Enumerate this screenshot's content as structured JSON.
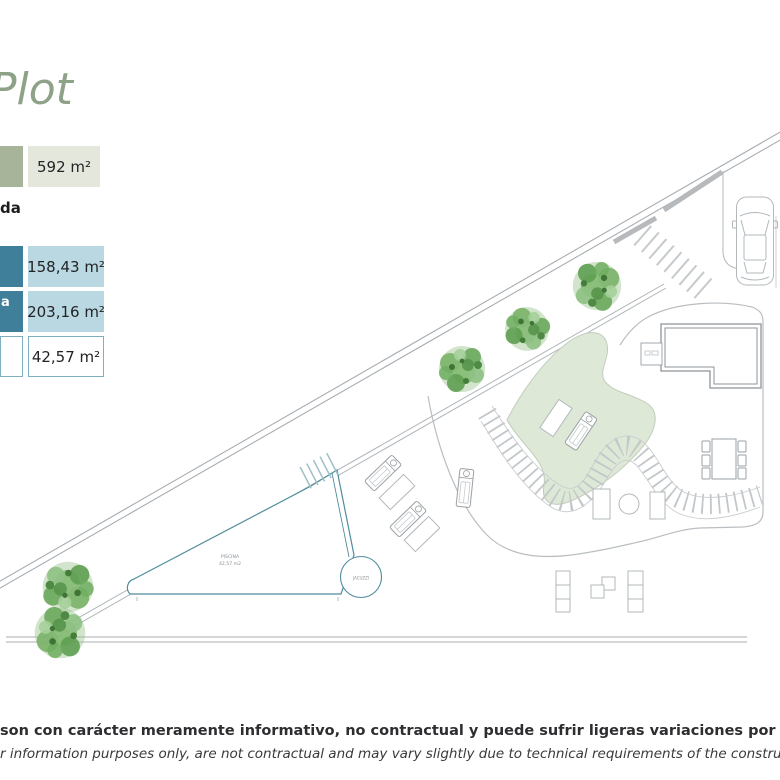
{
  "header": {
    "title": "Plot",
    "title_color": "#8da287"
  },
  "legend": {
    "plot_area": {
      "value": "592 m²",
      "swatch_color": "#a8b49a",
      "value_bg": "#e4e8dc"
    },
    "section_label_visible": "da",
    "rows": [
      {
        "label_visible": "",
        "value": "158,43 m²",
        "swatch_color": "#3f7f99",
        "value_bg": "#b9d8e1",
        "style": "solid"
      },
      {
        "label_visible": "a",
        "value": "203,16 m²",
        "swatch_color": "#3f7f99",
        "value_bg": "#b9d8e1",
        "style": "solid"
      },
      {
        "label_visible": "",
        "value": "42,57 m²",
        "swatch_color": "#ffffff",
        "value_bg": "#ffffff",
        "style": "outline",
        "border_color": "#7fb0c0"
      }
    ]
  },
  "site_plan": {
    "pool": {
      "name_label": "PISCINA",
      "area_label": "42,57 m2",
      "outline_color": "#4f8d9d"
    },
    "jacuzzi": {
      "label": "JACUZZI"
    },
    "lawn_color": "#dde8d6",
    "boundary_line_color": "#a8adb1",
    "tree_count": 5
  },
  "disclaimer": {
    "line1_es": "son con carácter meramente informativo, no contractual y puede sufrir ligeras variaciones por necesidades técnicas del proceso de c",
    "line2_en": "r information purposes only, are not contractual and may vary slightly due to technical requirements of the construction process."
  }
}
